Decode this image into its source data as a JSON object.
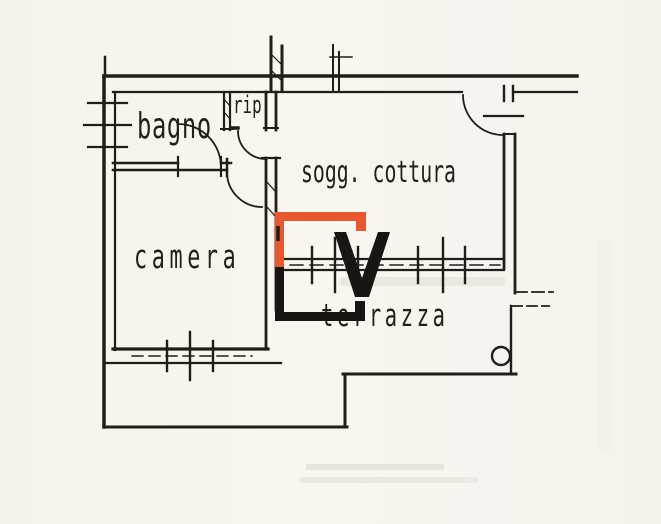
{
  "plan": {
    "rooms": [
      {
        "id": "bagno",
        "label": "bagno"
      },
      {
        "id": "rip",
        "label": "rip"
      },
      {
        "id": "sogg-cottura",
        "label": "sogg. cottura"
      },
      {
        "id": "camera",
        "label": "camera"
      },
      {
        "id": "terrazza",
        "label": "terrazza"
      }
    ]
  },
  "watermark": {
    "shape": "CV-monogram",
    "orange": "#e8582c",
    "black": "#181512"
  },
  "colors": {
    "ink": "#211d18",
    "paper": "#f7f5f0"
  }
}
